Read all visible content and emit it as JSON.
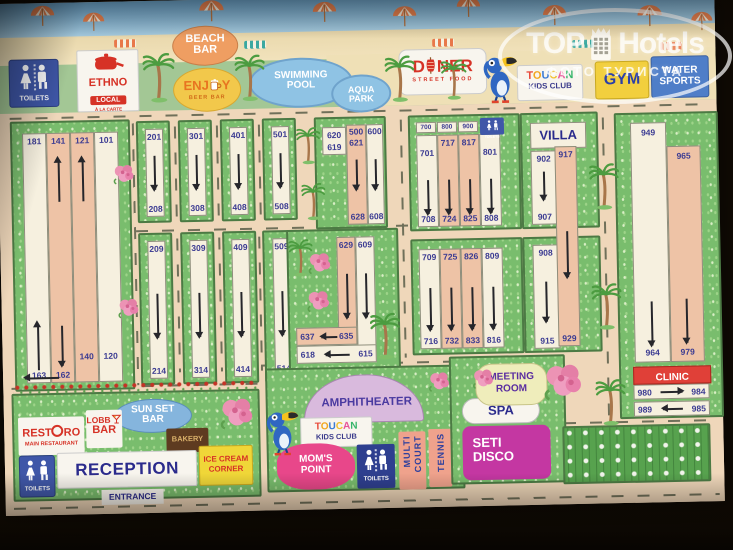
{
  "logo": {
    "word1": "TOP",
    "word2": "Hotels",
    "subtitle": "ФОТО ТУРИСТА"
  },
  "top": {
    "toilets": "TOILETS",
    "ethno": {
      "l1": "ETHNO",
      "l2": "LOCAL",
      "l3": "À LA CARTE"
    },
    "beach": {
      "l1": "BEACH",
      "l2": "BAR"
    },
    "enjoy": {
      "p1": "ENJ",
      "p2": "Y",
      "sub": "BEER BAR"
    },
    "pool": {
      "l1": "SWIMMING",
      "l2": "POOL"
    },
    "aqua": {
      "l1": "AQUA",
      "l2": "PARK"
    },
    "doner": {
      "p1": "D",
      "p2": "NER",
      "sub": "STREET FOOD"
    },
    "toucan": {
      "word": "TOUCAN",
      "sub": "KIDS CLUB"
    },
    "gym": "GYM",
    "water": {
      "l1": "WATER",
      "l2": "SPORTS"
    }
  },
  "blocks": {
    "west": {
      "t1": "181",
      "t2": "141",
      "t3": "121",
      "t4": "101",
      "b1": "163",
      "b2": "162",
      "b3": "140",
      "b4": "120"
    },
    "row1": [
      {
        "top": "201",
        "bottom": "208"
      },
      {
        "top": "301",
        "bottom": "308"
      },
      {
        "top": "401",
        "bottom": "408"
      },
      {
        "top": "501",
        "bottom": "508"
      }
    ],
    "row2": [
      {
        "top": "209",
        "bottom": "214"
      },
      {
        "top": "309",
        "bottom": "314"
      },
      {
        "top": "409",
        "bottom": "414"
      },
      {
        "top": "509",
        "bottom": "514"
      }
    ],
    "c_north": {
      "c1": "620",
      "c2": "619",
      "h1": "500",
      "h2": "600",
      "m": "621",
      "b1": "628",
      "b2": "608"
    },
    "c_south": {
      "v1": "629",
      "v2": "609",
      "a1l": "637",
      "a1r": "635",
      "a2l": "618",
      "a2r": "615"
    },
    "e7n": {
      "h1": "700",
      "h2": "800",
      "h3": "900",
      "toilets": "TOILETS",
      "s1t": "701",
      "s2t": "717",
      "s3t": "817",
      "s4t": "801",
      "b1": "708",
      "b2": "724",
      "b3": "825",
      "b4": "808"
    },
    "e7s": {
      "t1": "709",
      "t2": "725",
      "t3": "826",
      "t4": "809",
      "b1": "716",
      "b2": "732",
      "b3": "833",
      "b4": "816"
    },
    "villa_n": {
      "title": "VILLA",
      "lt": "902",
      "lb": "907"
    },
    "villa_s": {
      "lt": "908",
      "lb": "915"
    },
    "villa_tall": {
      "top": "917",
      "bottom": "929"
    },
    "east": {
      "lt": "949",
      "lb": "964",
      "rt": "965",
      "rb": "979",
      "clinic": "CLINIC",
      "r1l": "980",
      "r1r": "984",
      "r2l": "989",
      "r2r": "985"
    }
  },
  "sw": {
    "sunset1": "SUN SET",
    "sunset2": "BAR",
    "rest1": "REST",
    "rest2": "RO",
    "restsub": "MAIN RESTAURANT",
    "lobby1": "LOBB",
    "lobby2": "BAR",
    "bakery": "BAKERY",
    "toilets": "TOILETS",
    "reception": "RECEPTION",
    "ice1": "ICE CREAM",
    "ice2": "CORNER",
    "entrance": "ENTRANCE"
  },
  "sc": {
    "amphi": "AMPHITHEATER",
    "toucan": "TOUCAN",
    "toucansub": "KIDS CLUB",
    "moms1": "MOM'S",
    "moms2": "POINT",
    "toilets": "TOILETS",
    "multi1": "MULTI",
    "multi2": "COURT",
    "tennis": "TENNIS"
  },
  "se": {
    "meet1": "MEETING",
    "meet2": "ROOM",
    "spa": "SPA",
    "disco1": "SETI",
    "disco2": "DISCO"
  },
  "colors": {
    "accent_navy": "#3b3b92",
    "strip_salmon": "#eec3a6",
    "block_green": "#79bd6d",
    "clinic_red": "#e04038",
    "disco_magenta": "#c437a2",
    "gym_yellow": "#f2cf3e",
    "water_blue": "#4f7ec8",
    "toilets_blue": "#3f57a8",
    "pool_blue": "#8fc3e4"
  }
}
